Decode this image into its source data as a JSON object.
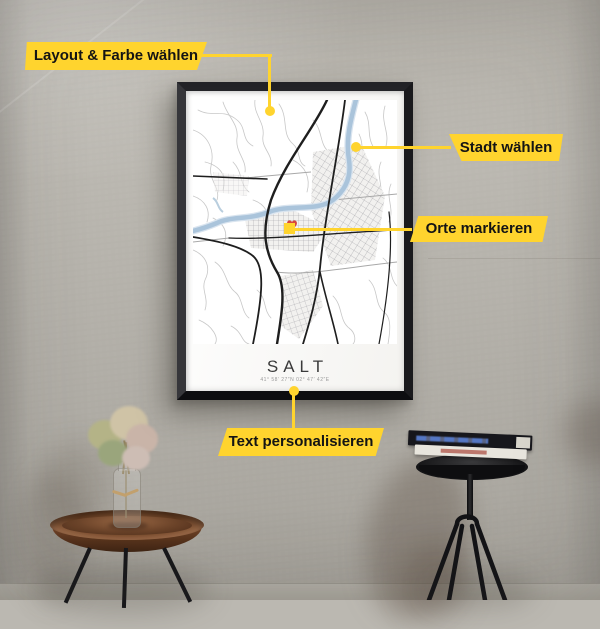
{
  "callouts": {
    "layout": {
      "label": "Layout & Farbe wählen"
    },
    "stadt": {
      "label": "Stadt wählen"
    },
    "orte": {
      "label": "Orte markieren"
    },
    "text": {
      "label": "Text personalisieren"
    }
  },
  "poster": {
    "title": "SALT",
    "coordinates": "41° 58′ 27″N 02° 47′ 42″E"
  },
  "icons": {
    "place_marker": "heart-icon",
    "callout_points": "yellow-dot"
  },
  "colors": {
    "accent_yellow": "#FFD42E",
    "marker_red": "#D6453D",
    "frame_black": "#1A1A1D",
    "river_blue": "#AAC4DB",
    "wall_gray": "#BBB8B1"
  }
}
